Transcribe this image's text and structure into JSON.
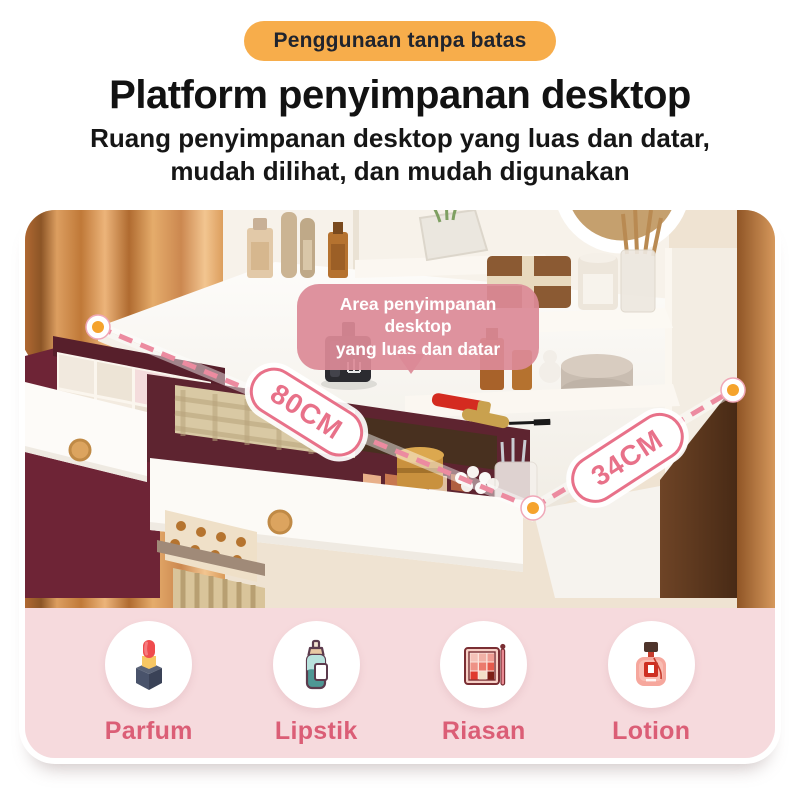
{
  "badge": {
    "label": "Penggunaan tanpa batas",
    "bg": "#F7AD4B",
    "text_color": "#20242E"
  },
  "header": {
    "title": "Platform penyimpanan desktop",
    "subtitle_line1": "Ruang penyimpanan desktop yang luas dan datar,",
    "subtitle_line2": "mudah dilihat, dan mudah digunakan"
  },
  "photo": {
    "description": "vanity-desk-with-open-drawers-and-cosmetics",
    "callout": {
      "line1": "Area penyimpanan desktop",
      "line2": "yang luas dan datar",
      "bg": "#DB8A97",
      "text_color": "#FFFFFF"
    },
    "dimensions": [
      {
        "label": "80CM",
        "edge": "front-width"
      },
      {
        "label": "34CM",
        "edge": "side-depth"
      }
    ],
    "dimension_style": {
      "pill_bg": "#FFFFFF",
      "pill_border": "#E87189",
      "pill_text": "#E87189",
      "dash_color": "#EC8BA0",
      "dot_color": "#F5A32C"
    }
  },
  "features": {
    "panel_bg": "#F6DADD",
    "label_color": "#DB5E76",
    "items": [
      {
        "label": "Parfum",
        "icon": "lipstick-icon"
      },
      {
        "label": "Lipstik",
        "icon": "serum-bottle-icon"
      },
      {
        "label": "Riasan",
        "icon": "makeup-palette-icon"
      },
      {
        "label": "Lotion",
        "icon": "perfume-bottle-icon"
      }
    ]
  }
}
